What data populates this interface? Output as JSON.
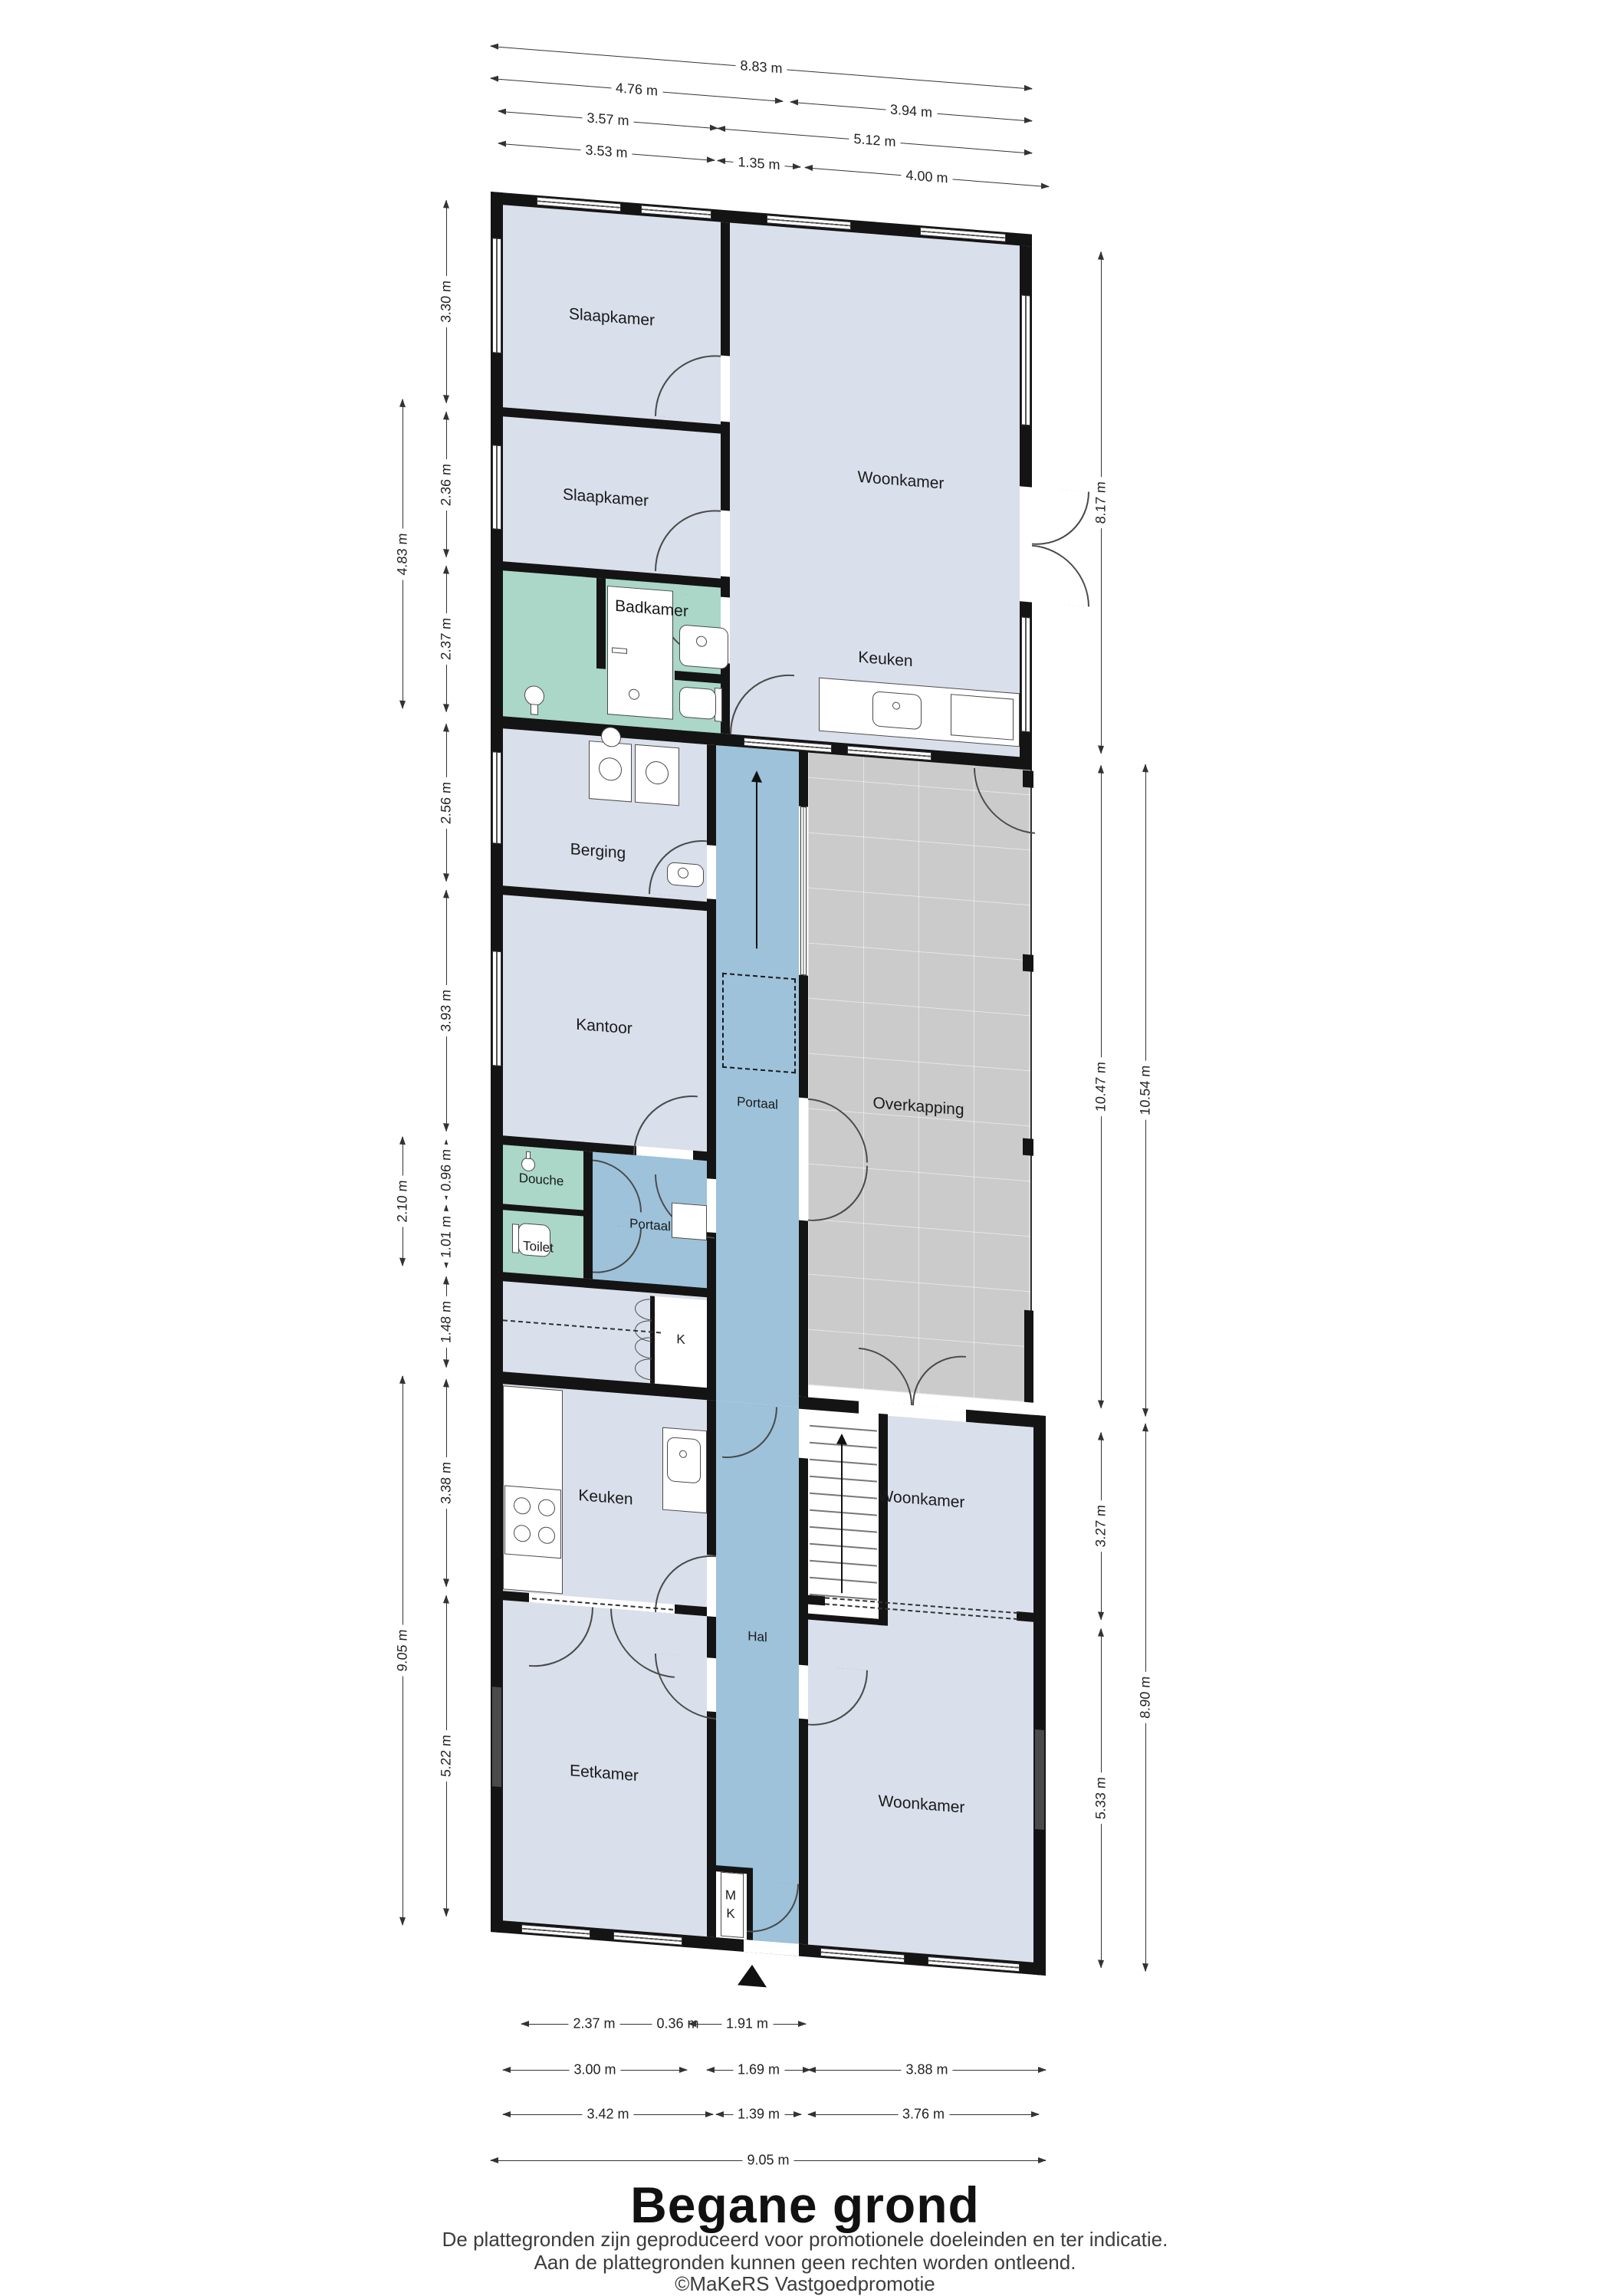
{
  "title": "Begane grond",
  "footer": {
    "line1": "De plattegronden zijn geproduceerd voor promotionele doeleinden en ter indicatie.",
    "line2": "Aan de plattegronden kunnen geen rechten worden ontleend.",
    "line3": "©MaKeRS Vastgoedpromotie"
  },
  "colors": {
    "wall": "#141414",
    "room_fill": "#d9dfeb",
    "wet_room_fill": "#aad7c7",
    "corridor_fill": "#9dc2da",
    "canopy_fill": "#cbcbcb"
  },
  "rooms": [
    {
      "id": "slaapkamer1",
      "label": "Slaapkamer"
    },
    {
      "id": "slaapkamer2",
      "label": "Slaapkamer"
    },
    {
      "id": "badkamer",
      "label": "Badkamer"
    },
    {
      "id": "woonkamer_back",
      "label": "Woonkamer"
    },
    {
      "id": "keuken_back",
      "label": "Keuken"
    },
    {
      "id": "berging",
      "label": "Berging"
    },
    {
      "id": "kantoor",
      "label": "Kantoor"
    },
    {
      "id": "douche",
      "label": "Douche"
    },
    {
      "id": "toilet",
      "label": "Toilet"
    },
    {
      "id": "portaal2",
      "label": "Portaal"
    },
    {
      "id": "portaal",
      "label": "Portaal"
    },
    {
      "id": "overkapping",
      "label": "Overkapping"
    },
    {
      "id": "kast",
      "label": "K"
    },
    {
      "id": "keuken_front",
      "label": "Keuken"
    },
    {
      "id": "woonkamer_mid",
      "label": "Woonkamer"
    },
    {
      "id": "hal",
      "label": "Hal"
    },
    {
      "id": "eetkamer",
      "label": "Eetkamer"
    },
    {
      "id": "woonkamer_front",
      "label": "Woonkamer"
    },
    {
      "id": "meterkast_m",
      "label": "M"
    },
    {
      "id": "meterkast_k",
      "label": "K"
    }
  ],
  "dimensions": {
    "top": [
      {
        "id": "t1",
        "label": "8.83 m"
      },
      {
        "id": "t2",
        "label": "4.76 m"
      },
      {
        "id": "t3",
        "label": "3.94 m"
      },
      {
        "id": "t4",
        "label": "3.57 m"
      },
      {
        "id": "t5",
        "label": "5.12 m"
      },
      {
        "id": "t6",
        "label": "3.53 m"
      },
      {
        "id": "t7",
        "label": "1.35 m"
      },
      {
        "id": "t8",
        "label": "4.00 m"
      }
    ],
    "left": [
      {
        "id": "l1",
        "label": "4.83 m"
      },
      {
        "id": "l2",
        "label": "2.10 m"
      },
      {
        "id": "l3",
        "label": "9.05 m"
      },
      {
        "id": "l4",
        "label": "3.30 m"
      },
      {
        "id": "l5",
        "label": "2.36 m"
      },
      {
        "id": "l6",
        "label": "2.37 m"
      },
      {
        "id": "l7",
        "label": "2.56 m"
      },
      {
        "id": "l8",
        "label": "3.93 m"
      },
      {
        "id": "l9",
        "label": "0.96 m"
      },
      {
        "id": "l10",
        "label": "1.01 m"
      },
      {
        "id": "l11",
        "label": "1.48 m"
      },
      {
        "id": "l12",
        "label": "3.38 m"
      },
      {
        "id": "l13",
        "label": "5.22 m"
      }
    ],
    "right": [
      {
        "id": "r1",
        "label": "8.17 m"
      },
      {
        "id": "r2",
        "label": "10.47 m"
      },
      {
        "id": "r3",
        "label": "3.27 m"
      },
      {
        "id": "r4",
        "label": "5.33 m"
      },
      {
        "id": "r5",
        "label": "10.54 m"
      },
      {
        "id": "r6",
        "label": "8.90 m"
      }
    ],
    "bottom": [
      {
        "id": "b1",
        "label": "2.37 m"
      },
      {
        "id": "b2",
        "label": "0.36 m"
      },
      {
        "id": "b3",
        "label": "1.91 m"
      },
      {
        "id": "b4",
        "label": "3.00 m"
      },
      {
        "id": "b5",
        "label": "1.69 m"
      },
      {
        "id": "b6",
        "label": "3.88 m"
      },
      {
        "id": "b7",
        "label": "3.42 m"
      },
      {
        "id": "b8",
        "label": "1.39 m"
      },
      {
        "id": "b9",
        "label": "3.76 m"
      },
      {
        "id": "b10",
        "label": "9.05 m"
      }
    ]
  }
}
